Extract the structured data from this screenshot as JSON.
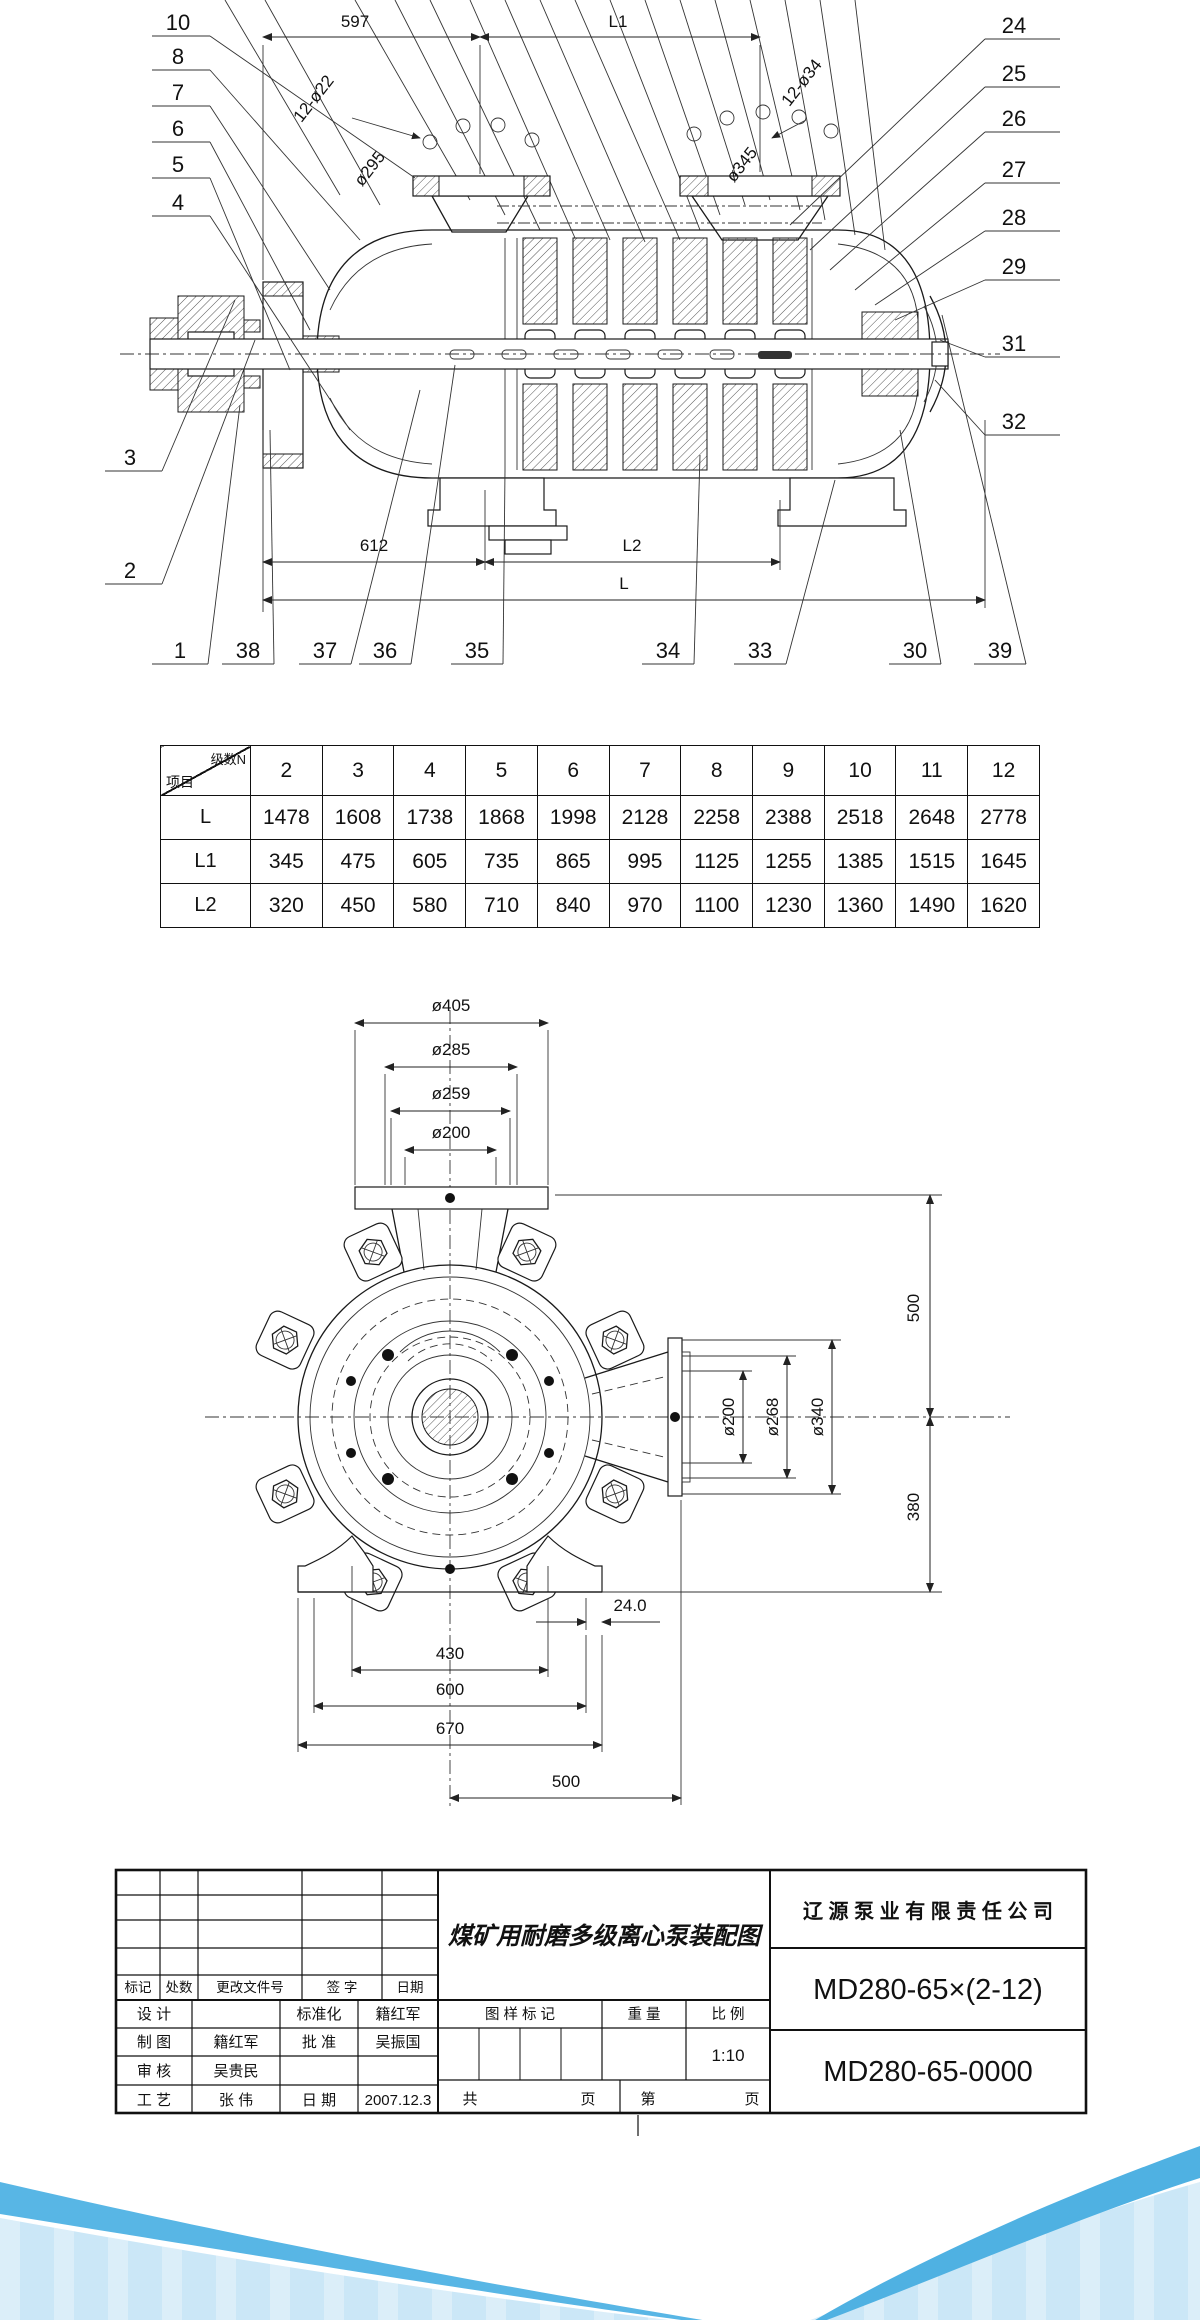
{
  "page": {
    "background": "#ffffff",
    "wave_light": "#cbe7f7",
    "wave_band_left": "#58b6e5",
    "wave_band_right": "#4fb1e2"
  },
  "top_drawing": {
    "dim_597": "597",
    "dim_L1": "L1",
    "dim_bolt_left": "12-ø22",
    "dim_d295": "ø295",
    "dim_d345": "ø345",
    "dim_bolt_right": "12-ø34",
    "dim_612": "612",
    "dim_L2": "L2",
    "dim_L": "L",
    "callouts_left": [
      "10",
      "8",
      "7",
      "6",
      "5",
      "4"
    ],
    "callouts_lower_left": [
      "3",
      "2"
    ],
    "callouts_bottom": [
      "1",
      "38",
      "37",
      "36",
      "35",
      "34",
      "33",
      "30",
      "39"
    ],
    "callouts_right": [
      "24",
      "25",
      "26",
      "27",
      "28",
      "29",
      "31",
      "32"
    ]
  },
  "stage_table": {
    "corner_top": "级数N",
    "corner_bottom": "项目",
    "stage_counts": [
      "2",
      "3",
      "4",
      "5",
      "6",
      "7",
      "8",
      "9",
      "10",
      "11",
      "12"
    ],
    "rows": [
      {
        "label": "L",
        "values": [
          "1478",
          "1608",
          "1738",
          "1868",
          "1998",
          "2128",
          "2258",
          "2388",
          "2518",
          "2648",
          "2778"
        ]
      },
      {
        "label": "L1",
        "values": [
          "345",
          "475",
          "605",
          "735",
          "865",
          "995",
          "1125",
          "1255",
          "1385",
          "1515",
          "1645"
        ]
      },
      {
        "label": "L2",
        "values": [
          "320",
          "450",
          "580",
          "710",
          "840",
          "970",
          "1100",
          "1230",
          "1360",
          "1490",
          "1620"
        ]
      }
    ]
  },
  "end_view": {
    "dim_d405": "ø405",
    "dim_d285": "ø285",
    "dim_d259": "ø259",
    "dim_d200_top": "ø200",
    "dim_500_right": "500",
    "dim_380_right": "380",
    "dim_d200_flange": "ø200",
    "dim_d268": "ø268",
    "dim_d340": "ø340",
    "dim_24": "24.0",
    "dim_430": "430",
    "dim_600": "600",
    "dim_670": "670",
    "dim_500_bottom": "500"
  },
  "title_block": {
    "company": "辽 源 泵 业 有 限 责 任 公 司",
    "drawing_title": "煤矿用耐磨多级离心泵装配图",
    "model": "MD280-65×(2-12)",
    "drawing_number": "MD280-65-0000",
    "rev_headers": [
      "标记",
      "处数",
      "更改文件号",
      "签 字",
      "日期"
    ],
    "sig_rows": [
      {
        "c1": "设 计",
        "c2": "",
        "c3": "标准化",
        "c4": "籍红军"
      },
      {
        "c1": "制 图",
        "c2": "籍红军",
        "c3": "批 准",
        "c4": "吴振国"
      },
      {
        "c1": "审 核",
        "c2": "吴贵民",
        "c3": "",
        "c4": ""
      },
      {
        "c1": "工 艺",
        "c2": "张 伟",
        "c3": "日 期",
        "c4": "2007.12.3"
      }
    ],
    "stamp_header": "图 样 标 记",
    "weight_header": "重 量",
    "scale_header": "比 例",
    "scale_value": "1:10",
    "pages_total_label": "共",
    "pages_page_label": "页",
    "pages_no_label": "第",
    "pages_page2_label": "页"
  }
}
